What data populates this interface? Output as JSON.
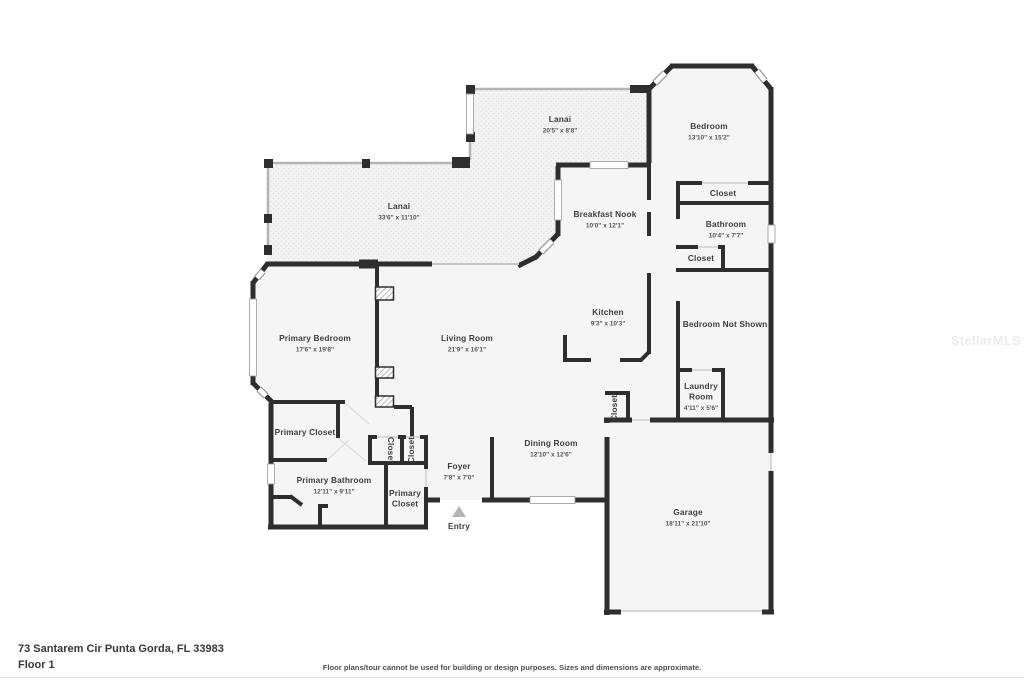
{
  "floorplan": {
    "rooms": [
      {
        "id": "lanai-top",
        "lines": [
          "Lanai"
        ],
        "dims": "20'5\" x 8'8\"",
        "x": 560,
        "y": 122
      },
      {
        "id": "bedroom",
        "lines": [
          "Bedroom"
        ],
        "dims": "13'10\" x 15'2\"",
        "x": 709,
        "y": 129
      },
      {
        "id": "lanai-left",
        "lines": [
          "Lanai"
        ],
        "dims": "33'6\" x 11'10\"",
        "x": 399,
        "y": 209
      },
      {
        "id": "breakfast-nook",
        "lines": [
          "Breakfast Nook"
        ],
        "dims": "10'0\" x 12'1\"",
        "x": 605,
        "y": 217
      },
      {
        "id": "closet-bedroom",
        "lines": [
          "Closet"
        ],
        "x": 723,
        "y": 196
      },
      {
        "id": "bathroom",
        "lines": [
          "Bathroom"
        ],
        "dims": "10'4\" x 7'7\"",
        "x": 726,
        "y": 227
      },
      {
        "id": "closet-bathroom",
        "lines": [
          "Closet"
        ],
        "x": 701,
        "y": 261
      },
      {
        "id": "kitchen",
        "lines": [
          "Kitchen"
        ],
        "dims": "9'3\" x 10'3\"",
        "x": 608,
        "y": 315
      },
      {
        "id": "bedroom-not-shown",
        "lines": [
          "Bedroom Not Shown"
        ],
        "x": 725,
        "y": 327
      },
      {
        "id": "laundry-room",
        "lines": [
          "Laundry",
          "Room"
        ],
        "dims": "4'11\" x 5'6\"",
        "x": 701,
        "y": 389
      },
      {
        "id": "primary-bedroom",
        "lines": [
          "Primary Bedroom"
        ],
        "dims": "17'6\" x 19'8\"",
        "x": 315,
        "y": 341
      },
      {
        "id": "living-room",
        "lines": [
          "Living Room"
        ],
        "dims": "21'9\" x 16'1\"",
        "x": 467,
        "y": 341
      },
      {
        "id": "primary-closet-upper",
        "lines": [
          "Primary Closet"
        ],
        "x": 305,
        "y": 435
      },
      {
        "id": "closet-hall-1",
        "lines": [
          "Closet"
        ],
        "x": 388,
        "y": 450,
        "rotate": 90
      },
      {
        "id": "closet-hall-2",
        "lines": [
          "Closet"
        ],
        "x": 414,
        "y": 450,
        "rotate": -90
      },
      {
        "id": "foyer",
        "lines": [
          "Foyer"
        ],
        "dims": "7'8\" x 7'0\"",
        "x": 459,
        "y": 469
      },
      {
        "id": "dining-room",
        "lines": [
          "Dining Room"
        ],
        "dims": "12'10\" x 12'6\"",
        "x": 551,
        "y": 446
      },
      {
        "id": "primary-bathroom",
        "lines": [
          "Primary Bathroom"
        ],
        "dims": "12'11\" x 9'11\"",
        "x": 334,
        "y": 483
      },
      {
        "id": "primary-closet-lower",
        "lines": [
          "Primary",
          "Closet"
        ],
        "x": 405,
        "y": 496
      },
      {
        "id": "closet-laundry",
        "lines": [
          "Closet"
        ],
        "x": 617,
        "y": 408,
        "rotate": -90
      },
      {
        "id": "entry",
        "lines": [
          "Entry"
        ],
        "x": 459,
        "y": 529
      },
      {
        "id": "garage",
        "lines": [
          "Garage"
        ],
        "dims": "18'11\" x 21'10\"",
        "x": 688,
        "y": 515
      }
    ]
  },
  "footer": {
    "address": "73 Santarem Cir Punta Gorda, FL 33983",
    "floor": "Floor 1",
    "disclaimer": "Floor plans/tour cannot be used for building or design purposes. Sizes and dimensions are approximate."
  },
  "watermark": "StellarMLS",
  "colors": {
    "wall": "#2e2e2e",
    "floor": "#f5f5f5",
    "window_frame": "#9a9a9a",
    "screen": "#b4b4b4",
    "door_line": "#cfcfcf",
    "label": "#3d3d3d",
    "dims": "#555555",
    "watermark": "#ebebeb",
    "entry_arrow": "#b5b5b5"
  }
}
